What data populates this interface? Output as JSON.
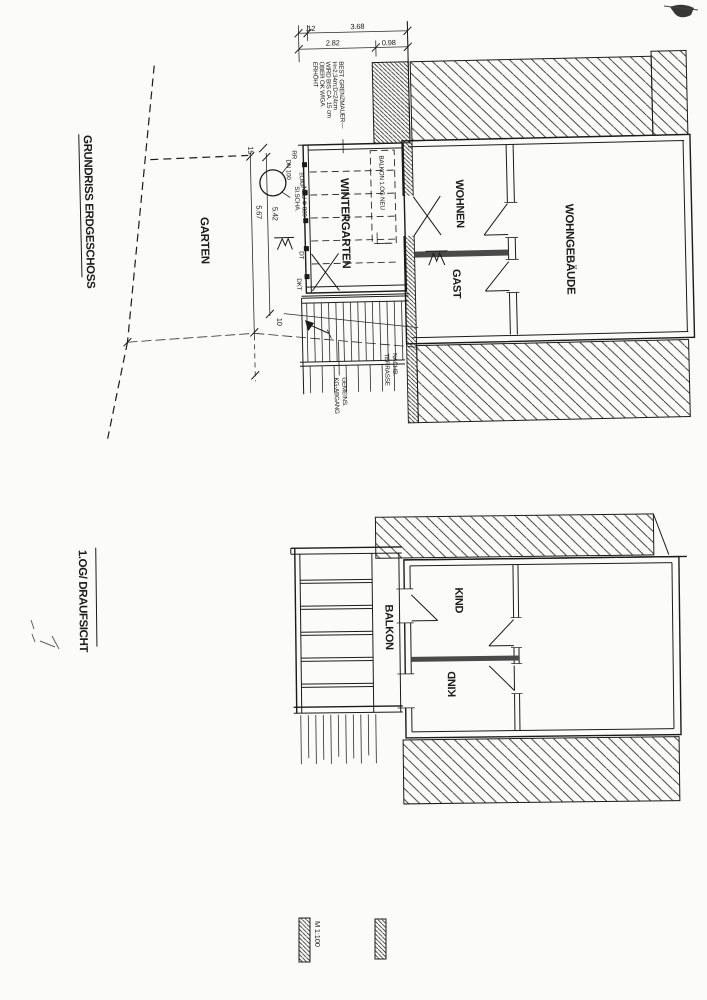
{
  "page": {
    "scale_label": "M 1:100"
  },
  "plan_top": {
    "title": "GRUNDRISS ERDGESCHOSS",
    "rooms": {
      "garten": "GARTEN",
      "wintergarten": "WINTERGARTEN",
      "wohnen": "WOHNEN",
      "gast": "GAST",
      "wohngebaeude": "WOHNGEBÄUDE"
    },
    "balkon_overlay": "BALKON 1.OG NEU",
    "note_lines": [
      "BEST. GRENZMAUER—",
      "H=2,34m;D=24cm",
      "WIRD BIS CA. 15 cm",
      "ÜBER OK WIGA.",
      "ERHÖHT"
    ],
    "dims": {
      "top_small": ".12",
      "top_total": "3.68",
      "mid_left": "2.82",
      "mid_right": "0.98",
      "side_top": "15",
      "side_len_outer": "5.67",
      "side_len_inner": "5.42",
      "side_bottom": "10"
    },
    "shaft": {
      "dn": "DN 100",
      "name": "SI.SCHA.",
      "dia": "NEU Φ 800"
    },
    "wall_marks": {
      "rr": "RR",
      "okf": "±OKF",
      "dt": "DT",
      "dkt": "DKT"
    },
    "stairs_label": [
      "GEMEINS.",
      "KG-ABGANG"
    ],
    "neighbor_label": [
      "NACHB.",
      "TERRASSE"
    ]
  },
  "plan_bottom": {
    "title": "1.OG/ DRAUFSICHT",
    "rooms": {
      "balkon": "BALKON",
      "kind_1": "KIND",
      "kind_2": "KIND"
    }
  }
}
